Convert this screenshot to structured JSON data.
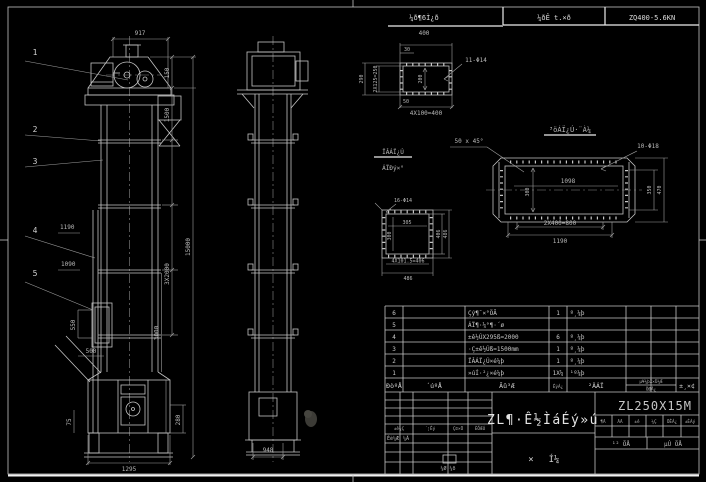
{
  "header": {
    "scale_label": "¼ð¶6Ì¿ð",
    "scale_value": "400",
    "field1": "¼ðÊ t.×ð",
    "field2": "ZQ400-5.6KN"
  },
  "front_view": {
    "balloons": [
      "1",
      "2",
      "3",
      "4",
      "5"
    ],
    "dims": {
      "top": "917",
      "h150": "150",
      "h1500": "1500",
      "overall": "15000",
      "sections": "3X2000",
      "h3000": "3000",
      "h580": "580",
      "h280": "280",
      "left1": "1190",
      "left2": "1090",
      "door_h": "550",
      "door_w": "500",
      "takeup": "75",
      "base": "1295"
    }
  },
  "side_view": {
    "dims": {
      "base": "948"
    }
  },
  "flange_detail": {
    "holes": "11-Φ14",
    "dims": {
      "offset": "30",
      "height": "290",
      "rows": "2X125=250",
      "inner": "200",
      "edge": "50",
      "spacing": "4X100=400"
    }
  },
  "inlet_detail": {
    "title1": "ÏÂÁÏ¿Ú",
    "title2": "ÁÏÐý×°",
    "holes": "16-Φ14",
    "dims": {
      "inner_w": "305",
      "inner_h": "300",
      "right_inner": "406",
      "right_outer": "486",
      "spacing": "4X101.5=406",
      "outer": "486"
    }
  },
  "outlet_detail": {
    "title": "³öÁÏ¿Ú·¨À¼",
    "chamfer": "50 x 45°",
    "holes": "10-Φ18",
    "dims": {
      "inner": "1098",
      "depth": "300",
      "right_inner": "350",
      "right_outer": "470",
      "spacing": "2X400=800",
      "outer": "1190"
    }
  },
  "bom": {
    "headers": {
      "no": "ÐòºÅ",
      "code": "´úºÅ",
      "name": "Ãû³Æ",
      "qty": "ÊýÁ¿",
      "material": "²ÄÁÏ",
      "weight": "µ¥¼þX×Ü¼Æ",
      "weight2": "ÖØÁ¿",
      "remark": "±¸×¢"
    },
    "rows": [
      {
        "no": "6",
        "name": "Çý¶¯×°ÖÃ",
        "qty": "1",
        "material": "º¸¼þ"
      },
      {
        "no": "5",
        "name": "ÁÏ¶·¼°¶·´ø",
        "qty": "",
        "material": ""
      },
      {
        "no": "4",
        "name": "±ê½ÚX295ß=2000",
        "qty": "6",
        "material": "º¸¼þ"
      },
      {
        "no": "3",
        "name": "·Ç±ê½Úß=1500mm",
        "qty": "1",
        "material": "º¸¼þ"
      },
      {
        "no": "2",
        "name": "ÏÂÁÏ¿Ú×é¼þ",
        "qty": "1",
        "material": "º¸¼þ"
      },
      {
        "no": "1",
        "name": "»úÍ·²¿×é¼þ",
        "qty": "1X¼",
        "material": "¹º¼þ"
      }
    ]
  },
  "title_block": {
    "title": "ZL¶·Ê½ÌáÉý»ú",
    "code": "ZL250X15M",
    "subtitle1": "×",
    "subtitle2": "Í¼",
    "rev": [
      "±ê¼Ç",
      "´¦Êý",
      "Ç©×Ö",
      "ÈÕÆÚ"
    ],
    "sign1": "Éè¼Æ",
    "sign2": "¼Ã",
    "approve": "¼Ø ¼ð",
    "attrs": [
      "¶Ã",
      "ÃÃ",
      "±ê",
      "¼Ç",
      "ÖÊÁ¿",
      "±ÈÀý"
    ],
    "sheet1": "¹² ÕÅ",
    "sheet2": "µÚ ÕÅ"
  }
}
